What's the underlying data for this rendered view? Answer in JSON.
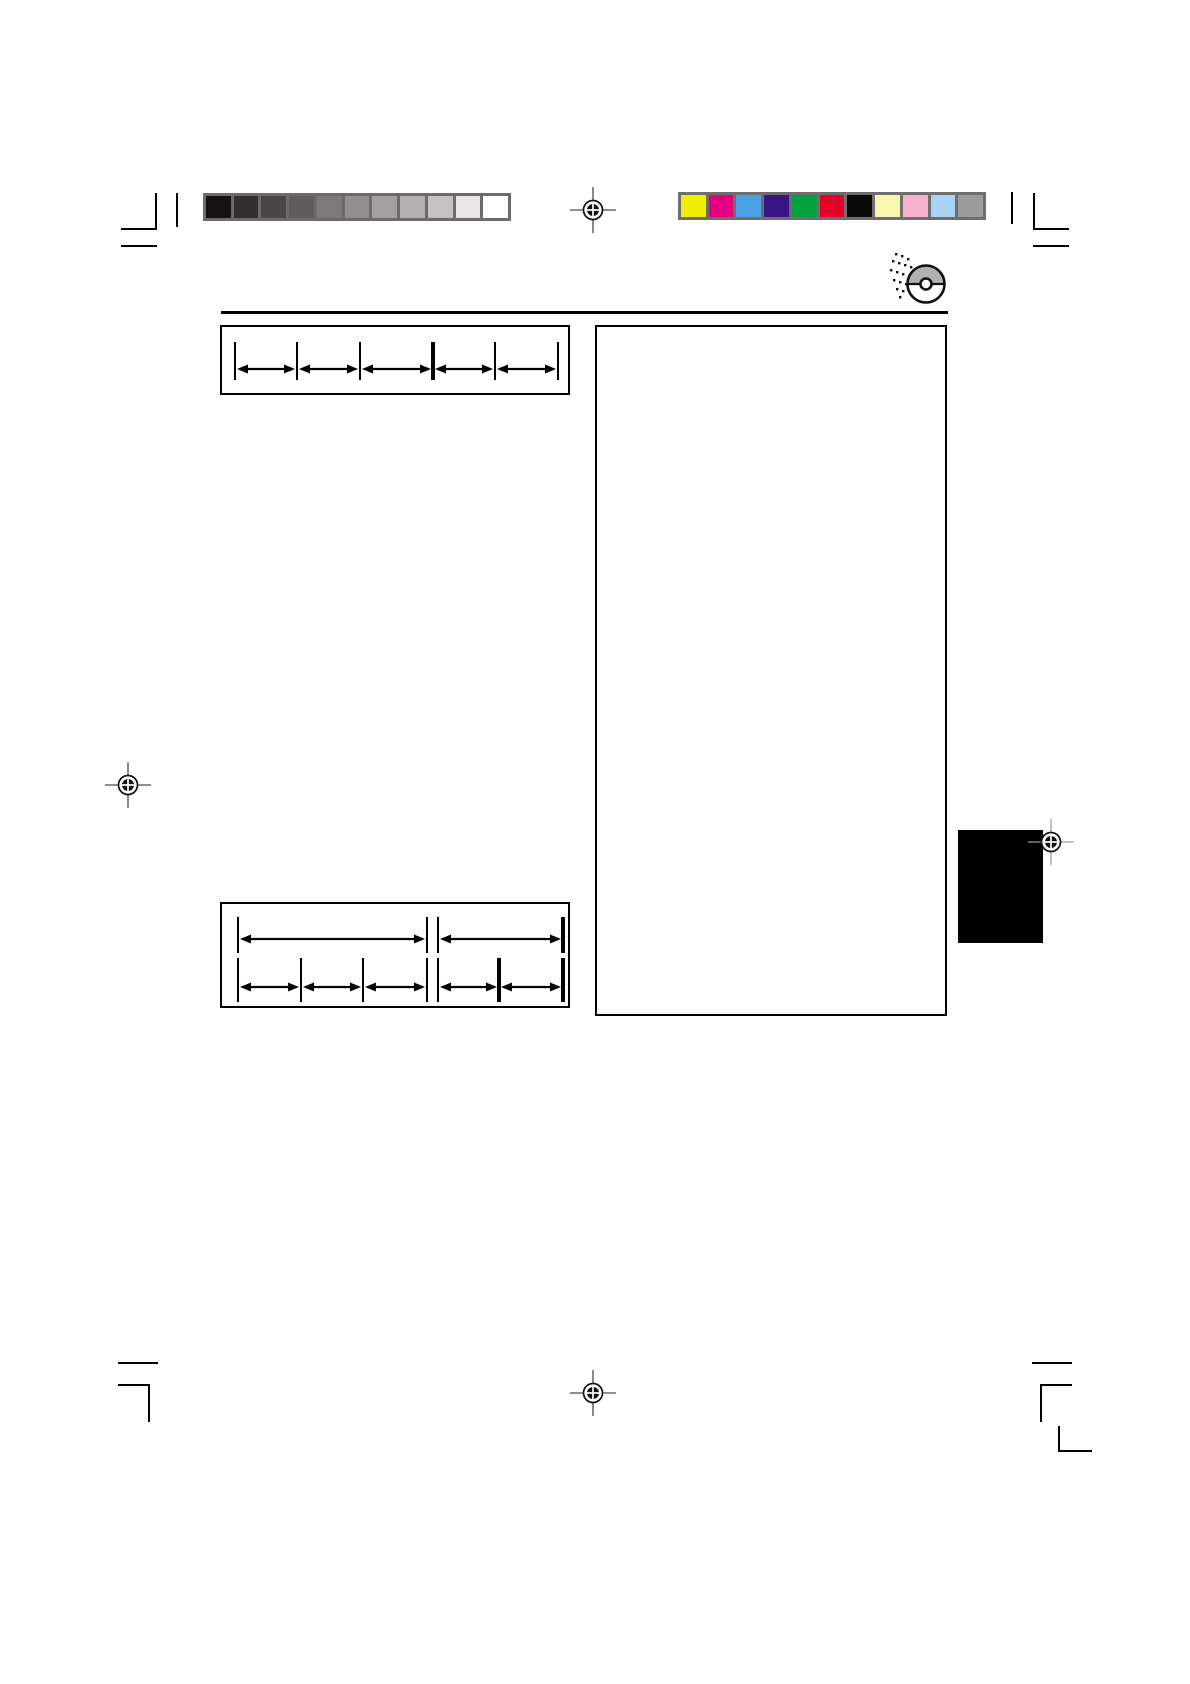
{
  "page": {
    "background": "#ffffff"
  },
  "calibration": {
    "grayscale_bar": {
      "frame_color": "#6e6a6b",
      "swatches": [
        "#161213",
        "#322d2e",
        "#4a4546",
        "#605b5c",
        "#7e7879",
        "#928d8e",
        "#a4a0a1",
        "#b4b0b1",
        "#c5c1c2",
        "#e8e6e7",
        "#ffffff"
      ]
    },
    "color_bar": {
      "frame_color": "#6e6e6e",
      "swatches": [
        "#f2ee00",
        "#e3007f",
        "#4aa2e2",
        "#3a1585",
        "#00a13e",
        "#e30029",
        "#0a0a0a",
        "#f7f7ae",
        "#f6b1cd",
        "#a8d3f2",
        "#9c9c9c"
      ]
    }
  },
  "icons": {
    "cd": "cd-icon",
    "registration_mark": "registration-mark-icon"
  },
  "colors": {
    "rule": "#000000",
    "box_border": "#000000",
    "tab": "#000000",
    "crop_mark": "#000000",
    "cd_top_half": "#b3b1b1"
  },
  "diagrams": {
    "interval_box_top": {
      "width": 346,
      "height": 66,
      "rows": [
        {
          "tick_top": 15,
          "tick_bottom": 53,
          "arrow_y": 42,
          "ticks": [
            {
              "x": 13,
              "bold": false
            },
            {
              "x": 75,
              "bold": false
            },
            {
              "x": 138,
              "bold": false
            },
            {
              "x": 211,
              "bold": true
            },
            {
              "x": 273,
              "bold": false
            },
            {
              "x": 336,
              "bold": false
            }
          ],
          "arrows": [
            [
              0,
              1
            ],
            [
              1,
              2
            ],
            [
              2,
              3
            ],
            [
              3,
              4
            ],
            [
              4,
              5
            ]
          ]
        }
      ]
    },
    "interval_box_bottom": {
      "width": 346,
      "height": 102,
      "rows": [
        {
          "tick_top": 13,
          "tick_bottom": 49,
          "arrow_y": 35,
          "ticks": [
            {
              "x": 16,
              "bold": false
            },
            {
              "x": 205,
              "bold": false
            },
            {
              "x": 216,
              "bold": false
            },
            {
              "x": 341,
              "bold": true
            }
          ],
          "arrows": [
            [
              0,
              1
            ],
            [
              2,
              3
            ]
          ]
        },
        {
          "tick_top": 54,
          "tick_bottom": 98,
          "arrow_y": 83,
          "ticks": [
            {
              "x": 16,
              "bold": false
            },
            {
              "x": 79,
              "bold": false
            },
            {
              "x": 141,
              "bold": false
            },
            {
              "x": 205,
              "bold": false
            },
            {
              "x": 216,
              "bold": false
            },
            {
              "x": 277,
              "bold": true
            },
            {
              "x": 341,
              "bold": true
            }
          ],
          "arrows": [
            [
              0,
              1
            ],
            [
              1,
              2
            ],
            [
              2,
              3
            ],
            [
              4,
              5
            ],
            [
              5,
              6
            ]
          ]
        }
      ]
    }
  }
}
